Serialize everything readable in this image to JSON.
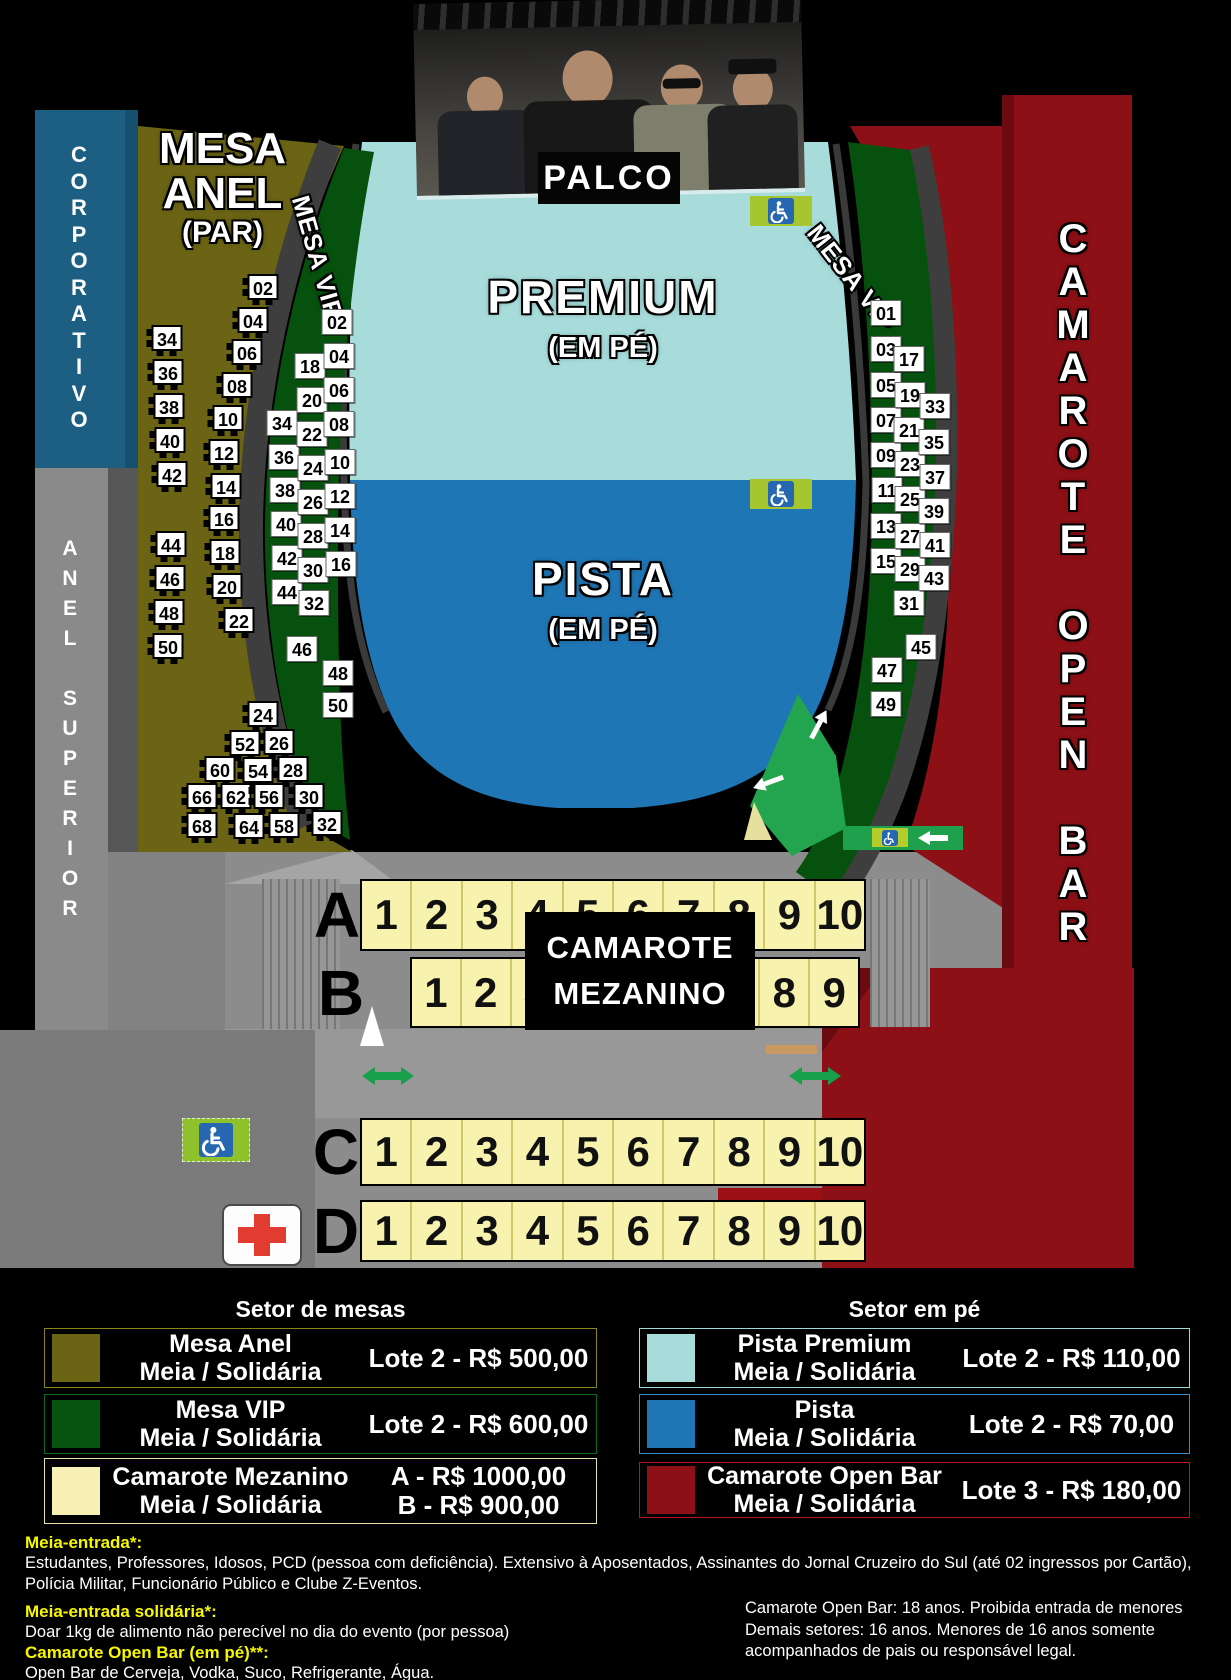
{
  "stage": {
    "palco_label": "PALCO"
  },
  "sections": {
    "corporativo": {
      "label": "CORPORATIVO"
    },
    "anel_superior": {
      "label": "ANEL SUPERIOR"
    },
    "mesa_anel": {
      "title": [
        "MESA",
        "ANEL",
        "(PAR)"
      ],
      "outer_tables": [
        "34",
        "36",
        "38",
        "40",
        "42",
        "44",
        "46",
        "48",
        "50"
      ],
      "inner_tables": [
        "02",
        "04",
        "06",
        "08",
        "10",
        "12",
        "14",
        "16",
        "18",
        "20",
        "22"
      ],
      "cluster_tables": [
        "24",
        "52",
        "26",
        "60",
        "54",
        "28",
        "66",
        "62",
        "56",
        "30",
        "68",
        "64",
        "58",
        "32"
      ]
    },
    "mesa_vip_left": {
      "label": "MESA VIP",
      "columns": [
        [
          "34",
          "36",
          "38",
          "40",
          "42",
          "44"
        ],
        [
          "18",
          "20",
          "22",
          "24",
          "26",
          "28",
          "30",
          "32"
        ],
        [
          "02",
          "04",
          "06",
          "08",
          "10",
          "12",
          "14",
          "16"
        ]
      ],
      "bottom": [
        "46",
        "48",
        "50"
      ]
    },
    "mesa_vip_right": {
      "label": "MESA VIP",
      "columns": [
        [
          "01",
          "03",
          "05",
          "07",
          "09",
          "11",
          "13",
          "15"
        ],
        [
          "17",
          "19",
          "21",
          "23",
          "25",
          "27",
          "29",
          "31"
        ],
        [
          "33",
          "35",
          "37",
          "39",
          "41",
          "43",
          "45"
        ]
      ],
      "bottom": [
        "47",
        "49"
      ]
    },
    "pista_premium": {
      "name": "PREMIUM",
      "mode": "(EM PÉ)"
    },
    "pista": {
      "name": "PISTA",
      "mode": "(EM PÉ)"
    },
    "camarote_open_bar": {
      "label": "CAMAROTE OPEN BAR"
    },
    "camarote_mezanino": {
      "overlay": [
        "CAMAROTE",
        "MEZANINO"
      ],
      "rows": [
        {
          "label": "A",
          "seats": [
            "1",
            "2",
            "3",
            "4",
            "5",
            "6",
            "7",
            "8",
            "9",
            "10"
          ]
        },
        {
          "label": "B",
          "seats": [
            "1",
            "2",
            "3",
            "4",
            "5",
            "6",
            "7",
            "8",
            "9"
          ]
        },
        {
          "label": "C",
          "seats": [
            "1",
            "2",
            "3",
            "4",
            "5",
            "6",
            "7",
            "8",
            "9",
            "10"
          ]
        },
        {
          "label": "D",
          "seats": [
            "1",
            "2",
            "3",
            "4",
            "5",
            "6",
            "7",
            "8",
            "9",
            "10"
          ]
        }
      ]
    }
  },
  "legend": {
    "left": {
      "title": "Setor de mesas",
      "items": [
        {
          "name": "Mesa Anel",
          "sub": "Meia / Solidária",
          "price": "Lote 2 - R$ 500,00",
          "color": "#6b6414",
          "border": "#8a841c"
        },
        {
          "name": "Mesa VIP",
          "sub": "Meia / Solidária",
          "price": "Lote 2 - R$ 600,00",
          "color": "#075410",
          "border": "#0c6a16"
        },
        {
          "name": "Camarote Mezanino",
          "sub": "Meia / Solidária",
          "price": "A - R$ 1000,00\nB - R$ 900,00",
          "color": "#f6f0b4",
          "border": "#e8e2a8"
        }
      ]
    },
    "right": {
      "title": "Setor em pé",
      "items": [
        {
          "name": "Pista Premium",
          "sub": "Meia / Solidária",
          "price": "Lote 2 - R$ 110,00",
          "color": "#a7dcdb",
          "border": "#9fd8d8"
        },
        {
          "name": "Pista",
          "sub": "Meia / Solidária",
          "price": "Lote 2 - R$ 70,00",
          "color": "#1f76b4",
          "border": "#3c8cc4"
        },
        {
          "name": "Camarote Open Bar",
          "sub": "Meia / Solidária",
          "price": "Lote 3 - R$ 180,00",
          "color": "#8c1015",
          "border": "#c01319"
        }
      ]
    }
  },
  "footer": {
    "notes": [
      {
        "heading": "Meia-entrada*:",
        "body": "Estudantes, Professores, Idosos, PCD (pessoa com deficiência). Extensivo à Aposentados, Assinantes do Jornal Cruzeiro do Sul (até 02 ingressos por Cartão), Polícia Militar, Funcionário Público e Clube Z-Eventos."
      },
      {
        "heading": "Meia-entrada solidária*:",
        "body": "Doar  1kg de alimento não perecível no dia do evento (por pessoa)"
      },
      {
        "heading": "Camarote Open Bar (em pé)**:",
        "body": "Open Bar de Cerveja, Vodka, Suco, Refrigerante, Água."
      }
    ],
    "age_restrictions": "Camarote Open Bar: 18 anos. Proibida entrada de menores\nDemais setores: 16 anos. Menores de 16 anos somente\nacompanhados  de pais ou responsável legal."
  },
  "icons": {
    "wheelchair": "wheelchair-accessible",
    "first_aid": "first-aid",
    "arrows": "direction-arrows"
  }
}
